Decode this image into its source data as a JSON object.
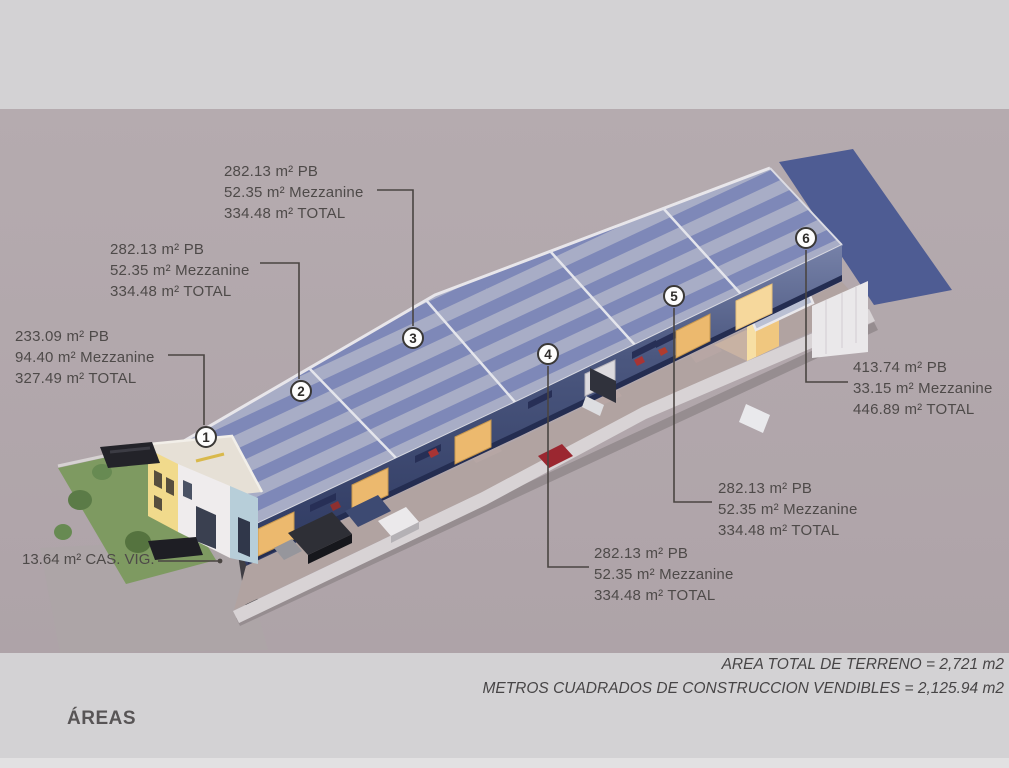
{
  "slide": {
    "heading": "ÁREAS",
    "summary_line_1": "AREA TOTAL DE TERRENO = 2,721 m2",
    "summary_line_2": "METROS CUADRADOS DE CONSTRUCCION VENDIBLES = 2,125.94 m2"
  },
  "units": [
    {
      "number": "1",
      "pb": "233.09 m² PB",
      "mezzanine": "94.40 m² Mezzanine",
      "total": "327.49 m² TOTAL"
    },
    {
      "number": "2",
      "pb": "282.13 m² PB",
      "mezzanine": "52.35 m² Mezzanine",
      "total": "334.48 m² TOTAL"
    },
    {
      "number": "3",
      "pb": "282.13 m² PB",
      "mezzanine": "52.35 m² Mezzanine",
      "total": "334.48 m² TOTAL"
    },
    {
      "number": "4",
      "pb": "282.13 m² PB",
      "mezzanine": "52.35 m² Mezzanine",
      "total": "334.48 m² TOTAL"
    },
    {
      "number": "5",
      "pb": "282.13 m² PB",
      "mezzanine": "52.35 m² Mezzanine",
      "total": "334.48 m² TOTAL"
    },
    {
      "number": "6",
      "pb": "413.74 m² PB",
      "mezzanine": "33.15 m² Mezzanine",
      "total": "446.89 m² TOTAL"
    }
  ],
  "guard_house": {
    "label": "13.64 m² CAS. VIG."
  },
  "colors": {
    "page_background": "#d3d2d4",
    "render_background": "#b2a8ad",
    "roof_stripe_light": "#a8adc6",
    "roof_stripe_dark": "#7e88b8",
    "flat_roof_dark_blue": "#4e5c93",
    "facade_dark_blue": "#3d4a75",
    "door_orange": "#ecb96e",
    "label_text": "#4e4a49"
  }
}
